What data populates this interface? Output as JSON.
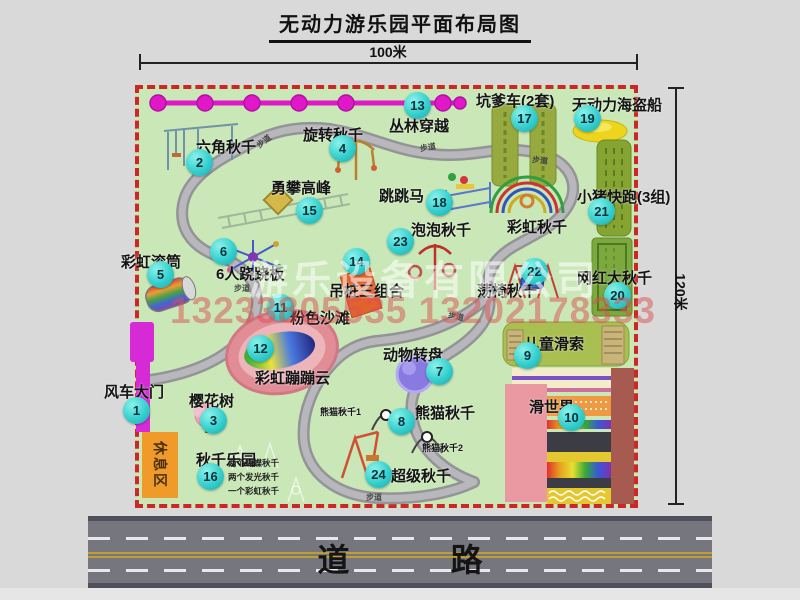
{
  "title": "无动力游乐园平面布局图",
  "dimension_top": "100米",
  "dimension_right": "120米",
  "road_label": "道 路",
  "trail_label": "步道",
  "rest_area_label": "休息区",
  "watermark": {
    "company": "游乐设备有限公司",
    "phones": "13233805535 13202178333"
  },
  "attractions": [
    {
      "num": "1",
      "name": "风车大门"
    },
    {
      "num": "2",
      "name": "六角秋千"
    },
    {
      "num": "3",
      "name": "樱花树"
    },
    {
      "num": "4",
      "name": "旋转秋千"
    },
    {
      "num": "5",
      "name": "彩虹滚筒"
    },
    {
      "num": "6",
      "name": "6人跷跷板"
    },
    {
      "num": "7",
      "name": "动物转盘"
    },
    {
      "num": "8",
      "name": "熊猫秋千"
    },
    {
      "num": "9",
      "name": "儿童滑索"
    },
    {
      "num": "10",
      "name": "滑世界"
    },
    {
      "num": "11",
      "name": "粉色沙滩"
    },
    {
      "num": "12",
      "name": "彩虹蹦蹦云"
    },
    {
      "num": "13",
      "name": "丛林穿越"
    },
    {
      "num": "14",
      "name": "吊桩三组合"
    },
    {
      "num": "15",
      "name": "勇攀高峰"
    },
    {
      "num": "16",
      "name": "秋千乐园"
    },
    {
      "num": "17",
      "name": "坑爹车(2套)"
    },
    {
      "num": "18",
      "name": "跳跳马"
    },
    {
      "num": "19",
      "name": "无动力海盗船"
    },
    {
      "num": "20",
      "name": "网红大秋千"
    },
    {
      "num": "21",
      "name": "小猪快跑(3组)"
    },
    {
      "num": "22",
      "name": "荡椅秋千"
    },
    {
      "num": "23",
      "name": "泡泡秋千"
    },
    {
      "num": "24",
      "name": "超级秋千"
    }
  ],
  "unnumbered_labels": {
    "rainbow_swing": "彩虹秋千",
    "panda_swing_1": "熊猫秋千1",
    "panda_swing_2": "熊猫秋千2"
  },
  "swing_park_notes": [
    "两个蝴蝶秋千",
    "两个发光秋千",
    "一个彩虹秋千"
  ],
  "colors": {
    "map_green": "#c9e7b7",
    "border_red": "#cc2626",
    "badge_cyan": "#35cfcd",
    "zipline_magenta": "#e018c8",
    "gate_magenta": "#d62ad6",
    "rest_area_orange": "#f09a2a",
    "road_gray": "#76767e",
    "pirate_ship_yellow": "#ecd51c"
  }
}
